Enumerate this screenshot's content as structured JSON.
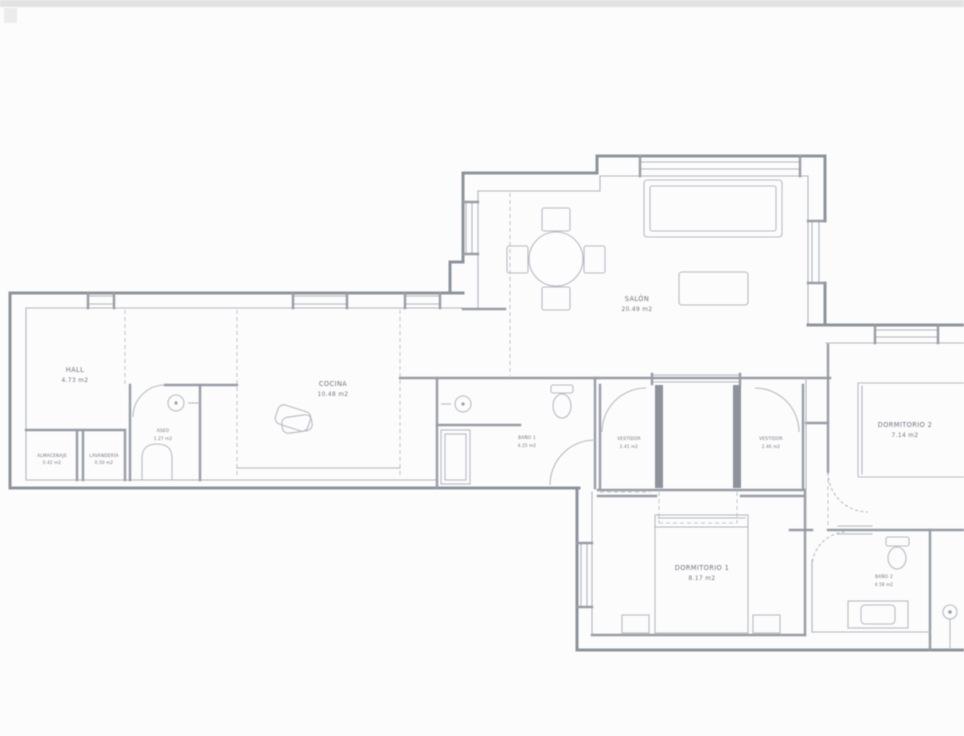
{
  "page": {
    "background_color": "#fcfcfd",
    "top_bar_color": "#dadada"
  },
  "plan": {
    "type": "apartment-floor-plan",
    "colors": {
      "wall": "#8e939b",
      "thin_line": "#b0b5bc",
      "dashed_line": "#bfc4cb",
      "furniture": "#b5bac1",
      "label_text": "#70757c"
    },
    "rooms": {
      "hall": {
        "name": "HALL",
        "area": "4.73 m2"
      },
      "almacenaje": {
        "name": "ALMACENAJE",
        "area": "0.42 m2"
      },
      "lavanderia": {
        "name": "LAVANDERÍA",
        "area": "0.50 m2"
      },
      "aseo": {
        "name": "ASEO",
        "area": "1.27 m2"
      },
      "cocina": {
        "name": "COCINA",
        "area": "10.48 m2"
      },
      "bano1": {
        "name": "BAÑO 1",
        "area": "4.25 m2"
      },
      "vestidor_izq": {
        "name": "VESTIDOR",
        "area": "2.41 m2"
      },
      "vestidor_der": {
        "name": "VESTIDOR",
        "area": "2.46 m2"
      },
      "salon": {
        "name": "SALÓN",
        "area": "20.49 m2"
      },
      "dormitorio1": {
        "name": "DORMITORIO 1",
        "area": "8.17 m2"
      },
      "dormitorio2": {
        "name": "DORMITORIO 2",
        "area": "7.14 m2"
      },
      "bano2": {
        "name": "BAÑO 2",
        "area": "4.58 m2"
      }
    }
  }
}
